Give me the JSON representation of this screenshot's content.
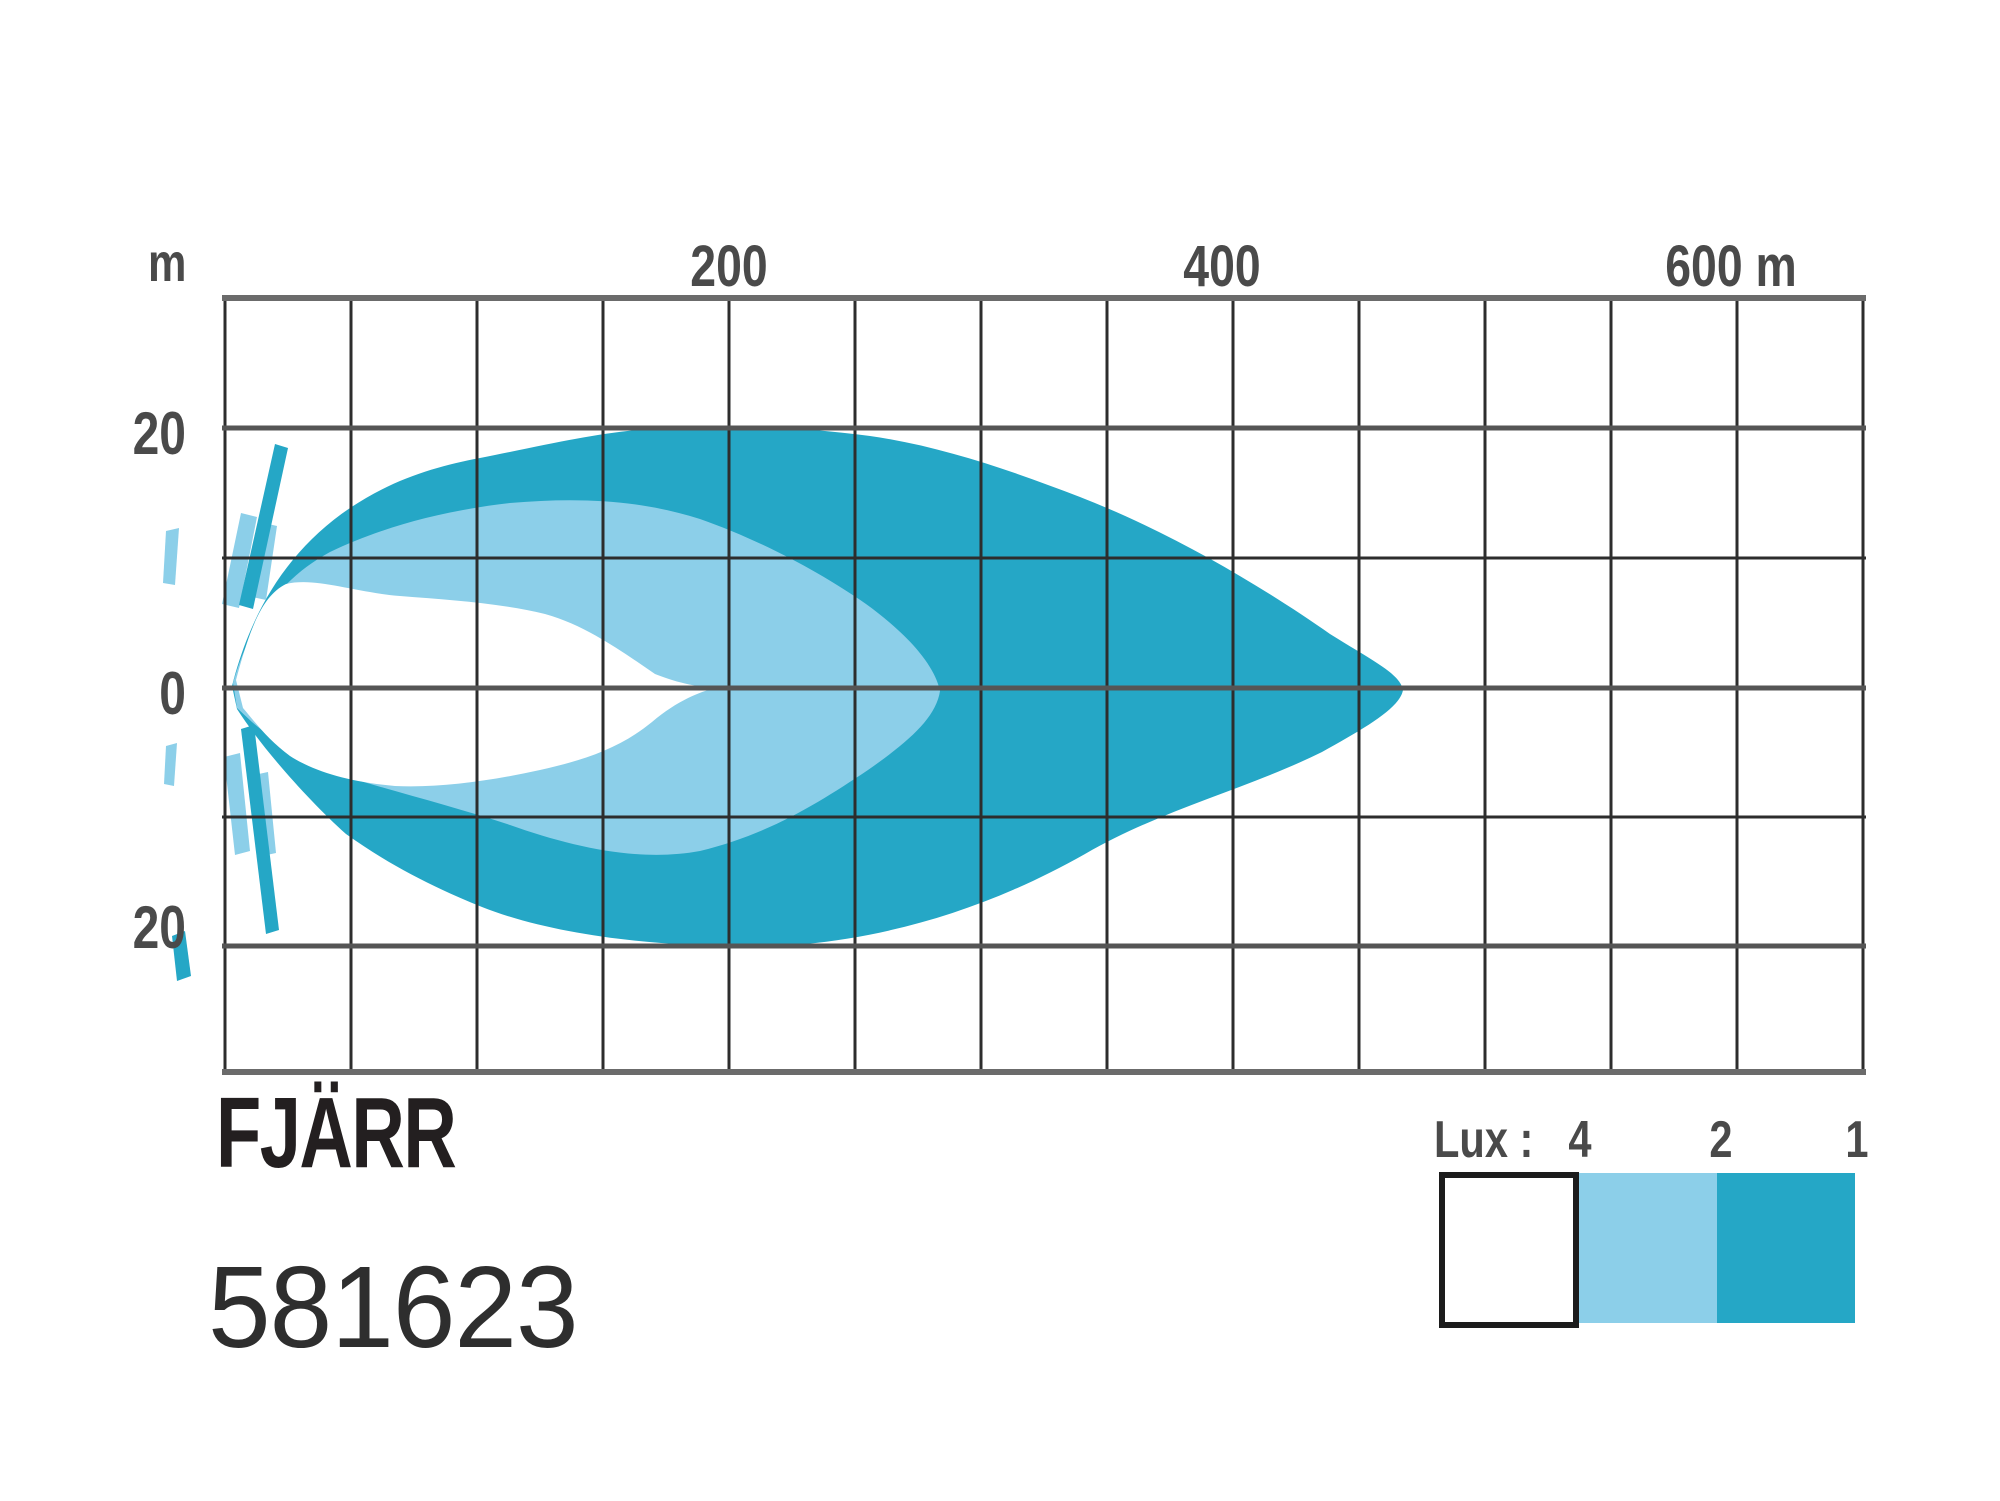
{
  "chart": {
    "unit_label": "m",
    "x_ticks": [
      {
        "label": "200"
      },
      {
        "label": "400"
      },
      {
        "label": "600 m"
      }
    ],
    "y_ticks": [
      {
        "label": "20"
      },
      {
        "label": "0"
      },
      {
        "label": "20"
      }
    ],
    "title": "FJÄRR",
    "product_number": "581623",
    "legend": {
      "label": "Lux :",
      "values": [
        "4",
        "2",
        "1"
      ]
    },
    "colors": {
      "beam_outer": "#25a7c6",
      "beam_mid": "#8ccfe9",
      "beam_inner": "#ffffff",
      "legend_box_border": "#1c1c1c",
      "grid_major": "#6b6b6b",
      "grid_mid": "#555555",
      "grid_minor": "#2d2d2d",
      "label_color": "#4a4a4a",
      "title_color": "#231f20"
    }
  },
  "chart_data": {
    "type": "area",
    "title": "FJÄRR",
    "product_number": "581623",
    "xlabel": "distance (m)",
    "ylabel": "beam spread (m)",
    "x_axis": {
      "unit": "m",
      "ticks": [
        200,
        400,
        600
      ],
      "range": [
        0,
        650
      ],
      "meters_per_cell": 50
    },
    "y_axis": {
      "unit": "m",
      "ticks": [
        20,
        0,
        -20
      ],
      "range": [
        -30,
        30
      ],
      "meters_per_cell": 10
    },
    "grid": true,
    "legend_position": "bottom-right",
    "series": [
      {
        "name": "1 Lux",
        "color": "#25a7c6",
        "reach_m": 467,
        "max_width_m": {
          "top": 20,
          "bottom": -20
        },
        "profile_top": [
          [
            0,
            0
          ],
          [
            30,
            9
          ],
          [
            60,
            15
          ],
          [
            100,
            17.5
          ],
          [
            150,
            19.5
          ],
          [
            190,
            20.2
          ],
          [
            250,
            19
          ],
          [
            300,
            17
          ],
          [
            350,
            14
          ],
          [
            400,
            10
          ],
          [
            430,
            5
          ],
          [
            467,
            0
          ]
        ],
        "profile_bottom": [
          [
            0,
            0
          ],
          [
            30,
            -9
          ],
          [
            60,
            -14
          ],
          [
            100,
            -17
          ],
          [
            150,
            -19
          ],
          [
            190,
            -20
          ],
          [
            250,
            -19
          ],
          [
            300,
            -17
          ],
          [
            350,
            -13.5
          ],
          [
            400,
            -9
          ],
          [
            430,
            -5
          ],
          [
            467,
            0
          ]
        ]
      },
      {
        "name": "2 Lux",
        "color": "#8ccfe9",
        "reach_m": 284,
        "max_width_m": {
          "top": 14.5,
          "bottom": -13
        },
        "profile_top": [
          [
            0,
            0
          ],
          [
            25,
            7
          ],
          [
            60,
            12
          ],
          [
            110,
            14.5
          ],
          [
            160,
            13.5
          ],
          [
            200,
            11
          ],
          [
            240,
            7
          ],
          [
            270,
            3
          ],
          [
            284,
            0
          ]
        ],
        "profile_bottom": [
          [
            0,
            0
          ],
          [
            25,
            -5
          ],
          [
            60,
            -8.5
          ],
          [
            110,
            -10.5
          ],
          [
            150,
            -11.5
          ],
          [
            180,
            -13
          ],
          [
            220,
            -12.5
          ],
          [
            250,
            -8
          ],
          [
            270,
            -4
          ],
          [
            284,
            0
          ]
        ]
      },
      {
        "name": "4 Lux",
        "color": "#ffffff",
        "reach_m": 195,
        "max_width_m": {
          "top": 8,
          "bottom": -7.8
        },
        "profile_top": [
          [
            0,
            0
          ],
          [
            10,
            7.5
          ],
          [
            40,
            7.5
          ],
          [
            80,
            7
          ],
          [
            120,
            5.5
          ],
          [
            155,
            3.5
          ],
          [
            195,
            0
          ]
        ],
        "profile_bottom": [
          [
            0,
            0
          ],
          [
            15,
            -5.5
          ],
          [
            45,
            -7
          ],
          [
            70,
            -7.8
          ],
          [
            100,
            -7.5
          ],
          [
            135,
            -6
          ],
          [
            165,
            -3.5
          ],
          [
            195,
            0
          ]
        ]
      }
    ]
  }
}
